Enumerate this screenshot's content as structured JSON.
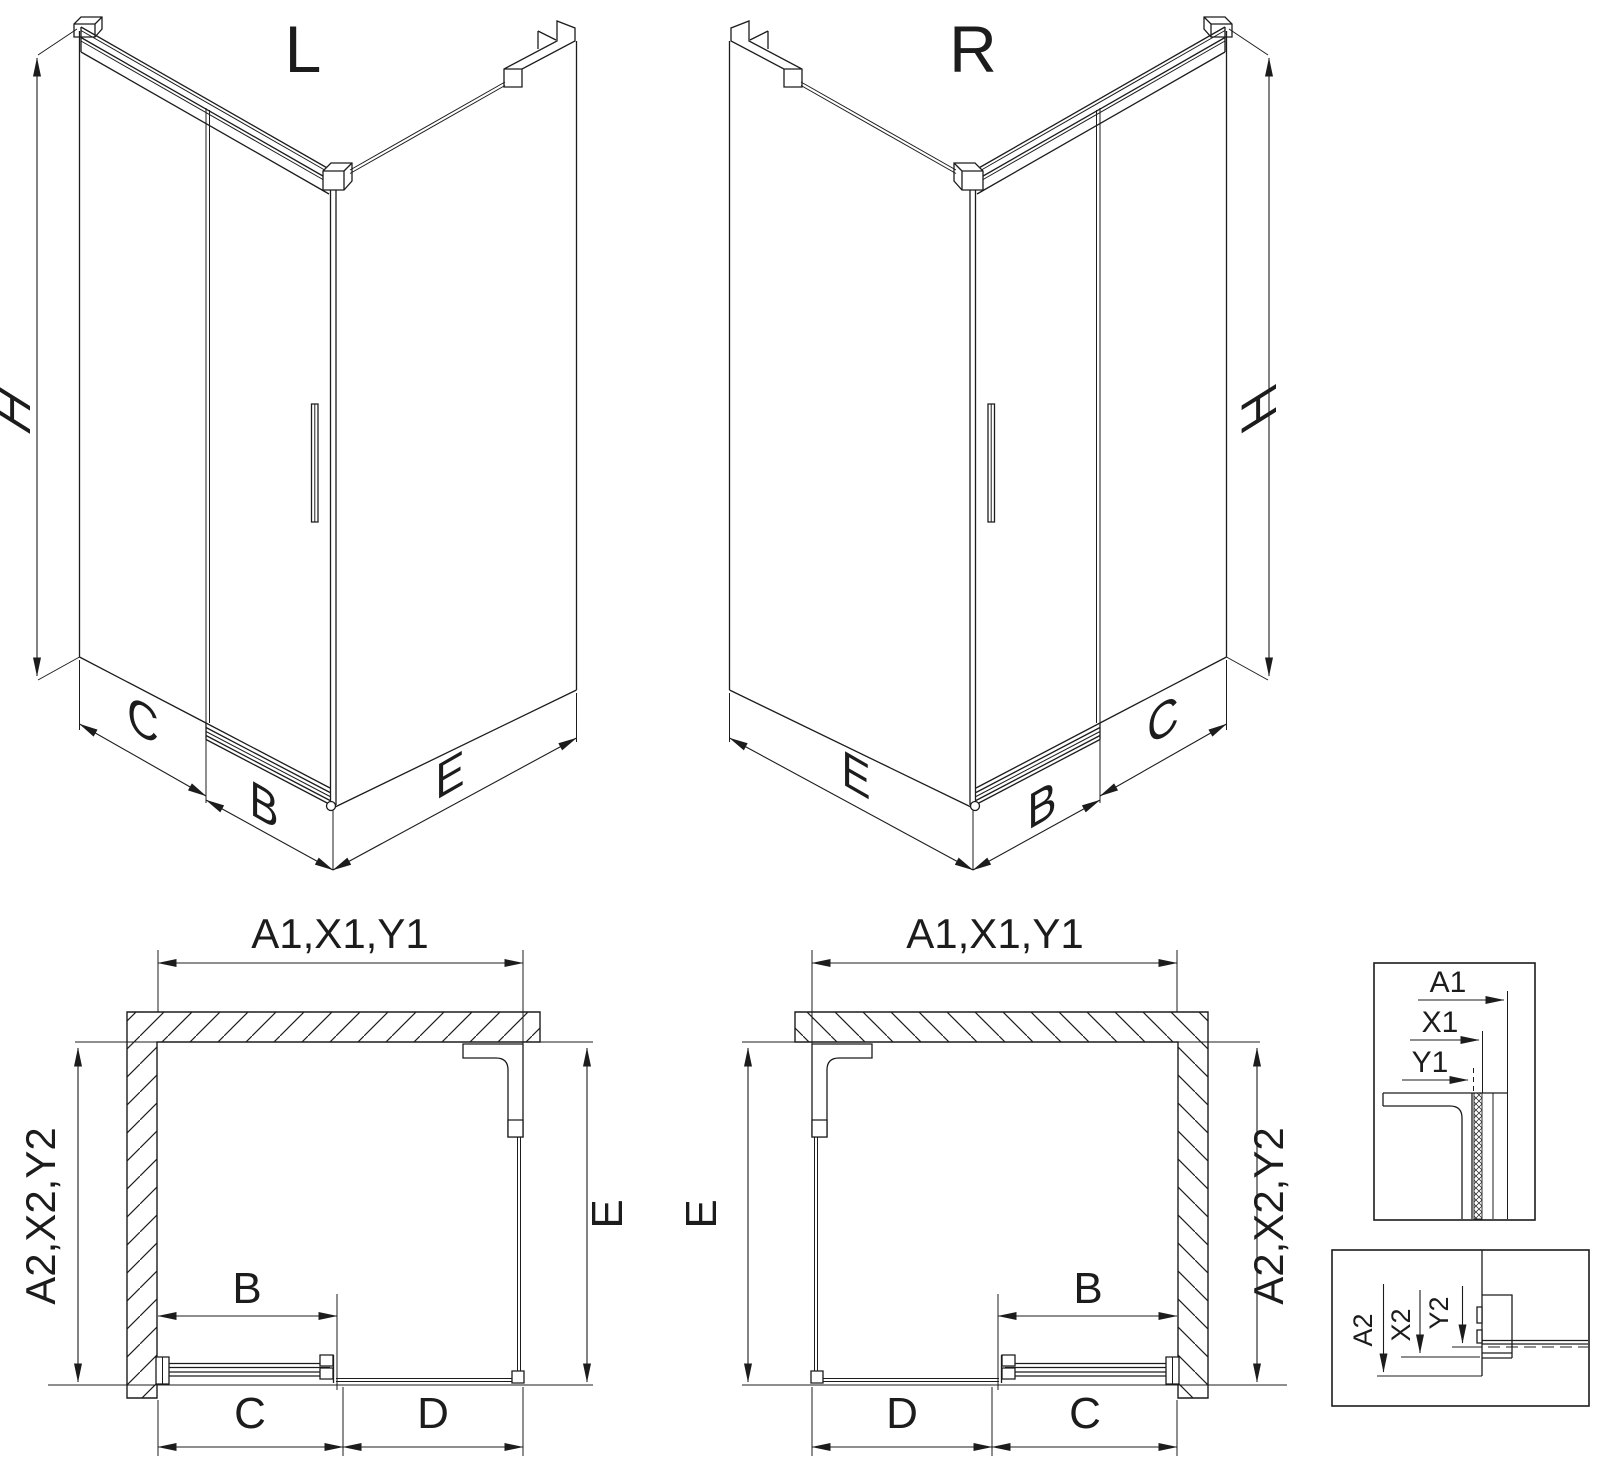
{
  "page": {
    "background": "#ffffff",
    "line_color": "#1c1c1c"
  },
  "iso_left": {
    "title": "L",
    "dim_height": "H",
    "dim_fixed_side": "C",
    "dim_door": "B",
    "dim_return": "E"
  },
  "iso_right": {
    "title": "R",
    "dim_height": "H",
    "dim_fixed_side": "C",
    "dim_door": "B",
    "dim_return": "E"
  },
  "plan_left": {
    "dim_top": "A1,X1,Y1",
    "dim_side": "A2,X2,Y2",
    "dim_depth": "E",
    "dim_door": "B",
    "dim_door_travel": "C",
    "dim_fixed": "D"
  },
  "plan_right": {
    "dim_top": "A1,X1,Y1",
    "dim_side": "A2,X2,Y2",
    "dim_depth": "E",
    "dim_door": "B",
    "dim_door_travel": "C",
    "dim_fixed": "D"
  },
  "detail_top": {
    "dim_1": "A1",
    "dim_2": "X1",
    "dim_3": "Y1"
  },
  "detail_bottom": {
    "dim_1": "A2",
    "dim_2": "X2",
    "dim_3": "Y2"
  }
}
